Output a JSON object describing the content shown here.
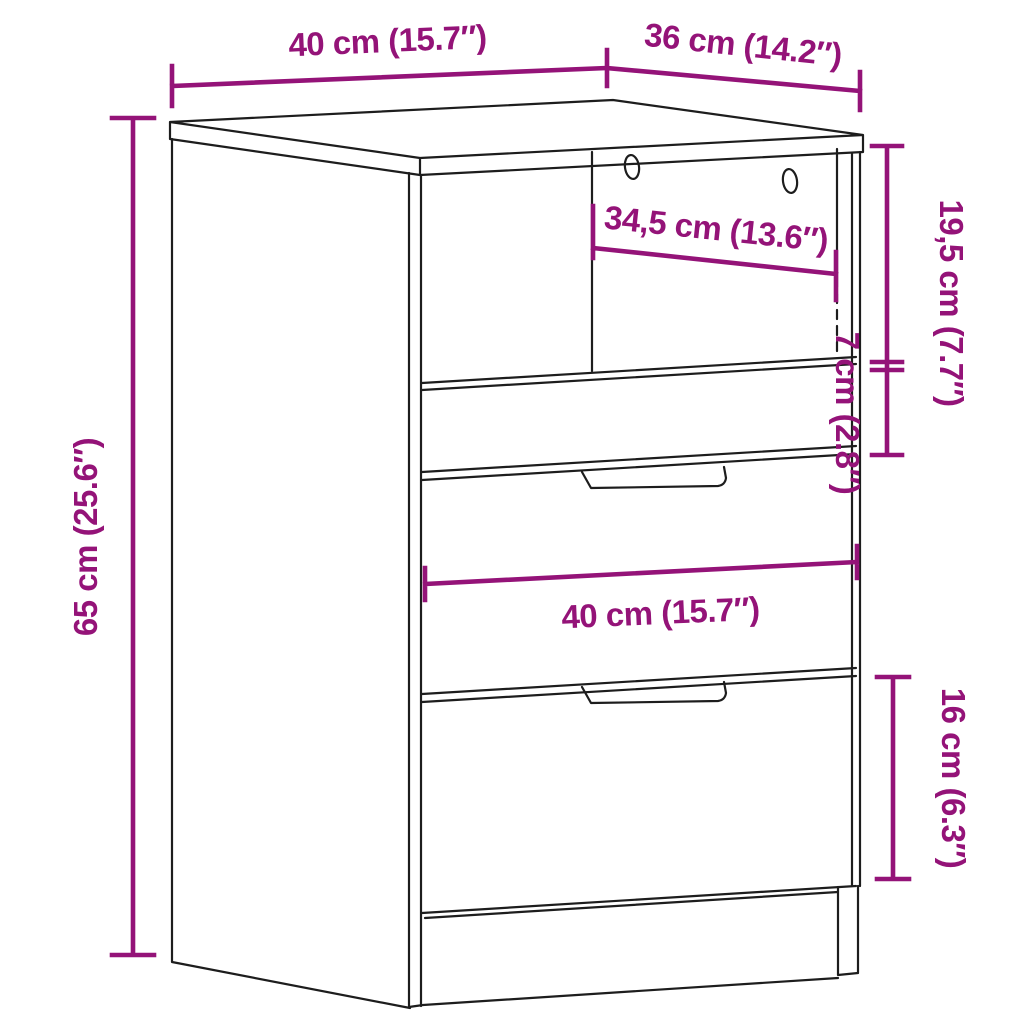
{
  "title": "Cabinet / bedside table dimension diagram",
  "colors": {
    "background": "#ffffff",
    "outline": "#1d1d1d",
    "dimension": "#941378"
  },
  "dimensions": {
    "top_width": "40 cm (15.7″)",
    "top_depth": "36 cm (14.2″)",
    "overall_height": "65 cm (25.6″)",
    "interior_width": "34,5 cm (13.6″)",
    "upper_section_height": "19,5 cm (7.7″)",
    "small_drawer_height": "7 cm (2.8″)",
    "front_width": "40 cm (15.7″)",
    "bottom_drawer_height": "16 cm (6.3″)"
  }
}
